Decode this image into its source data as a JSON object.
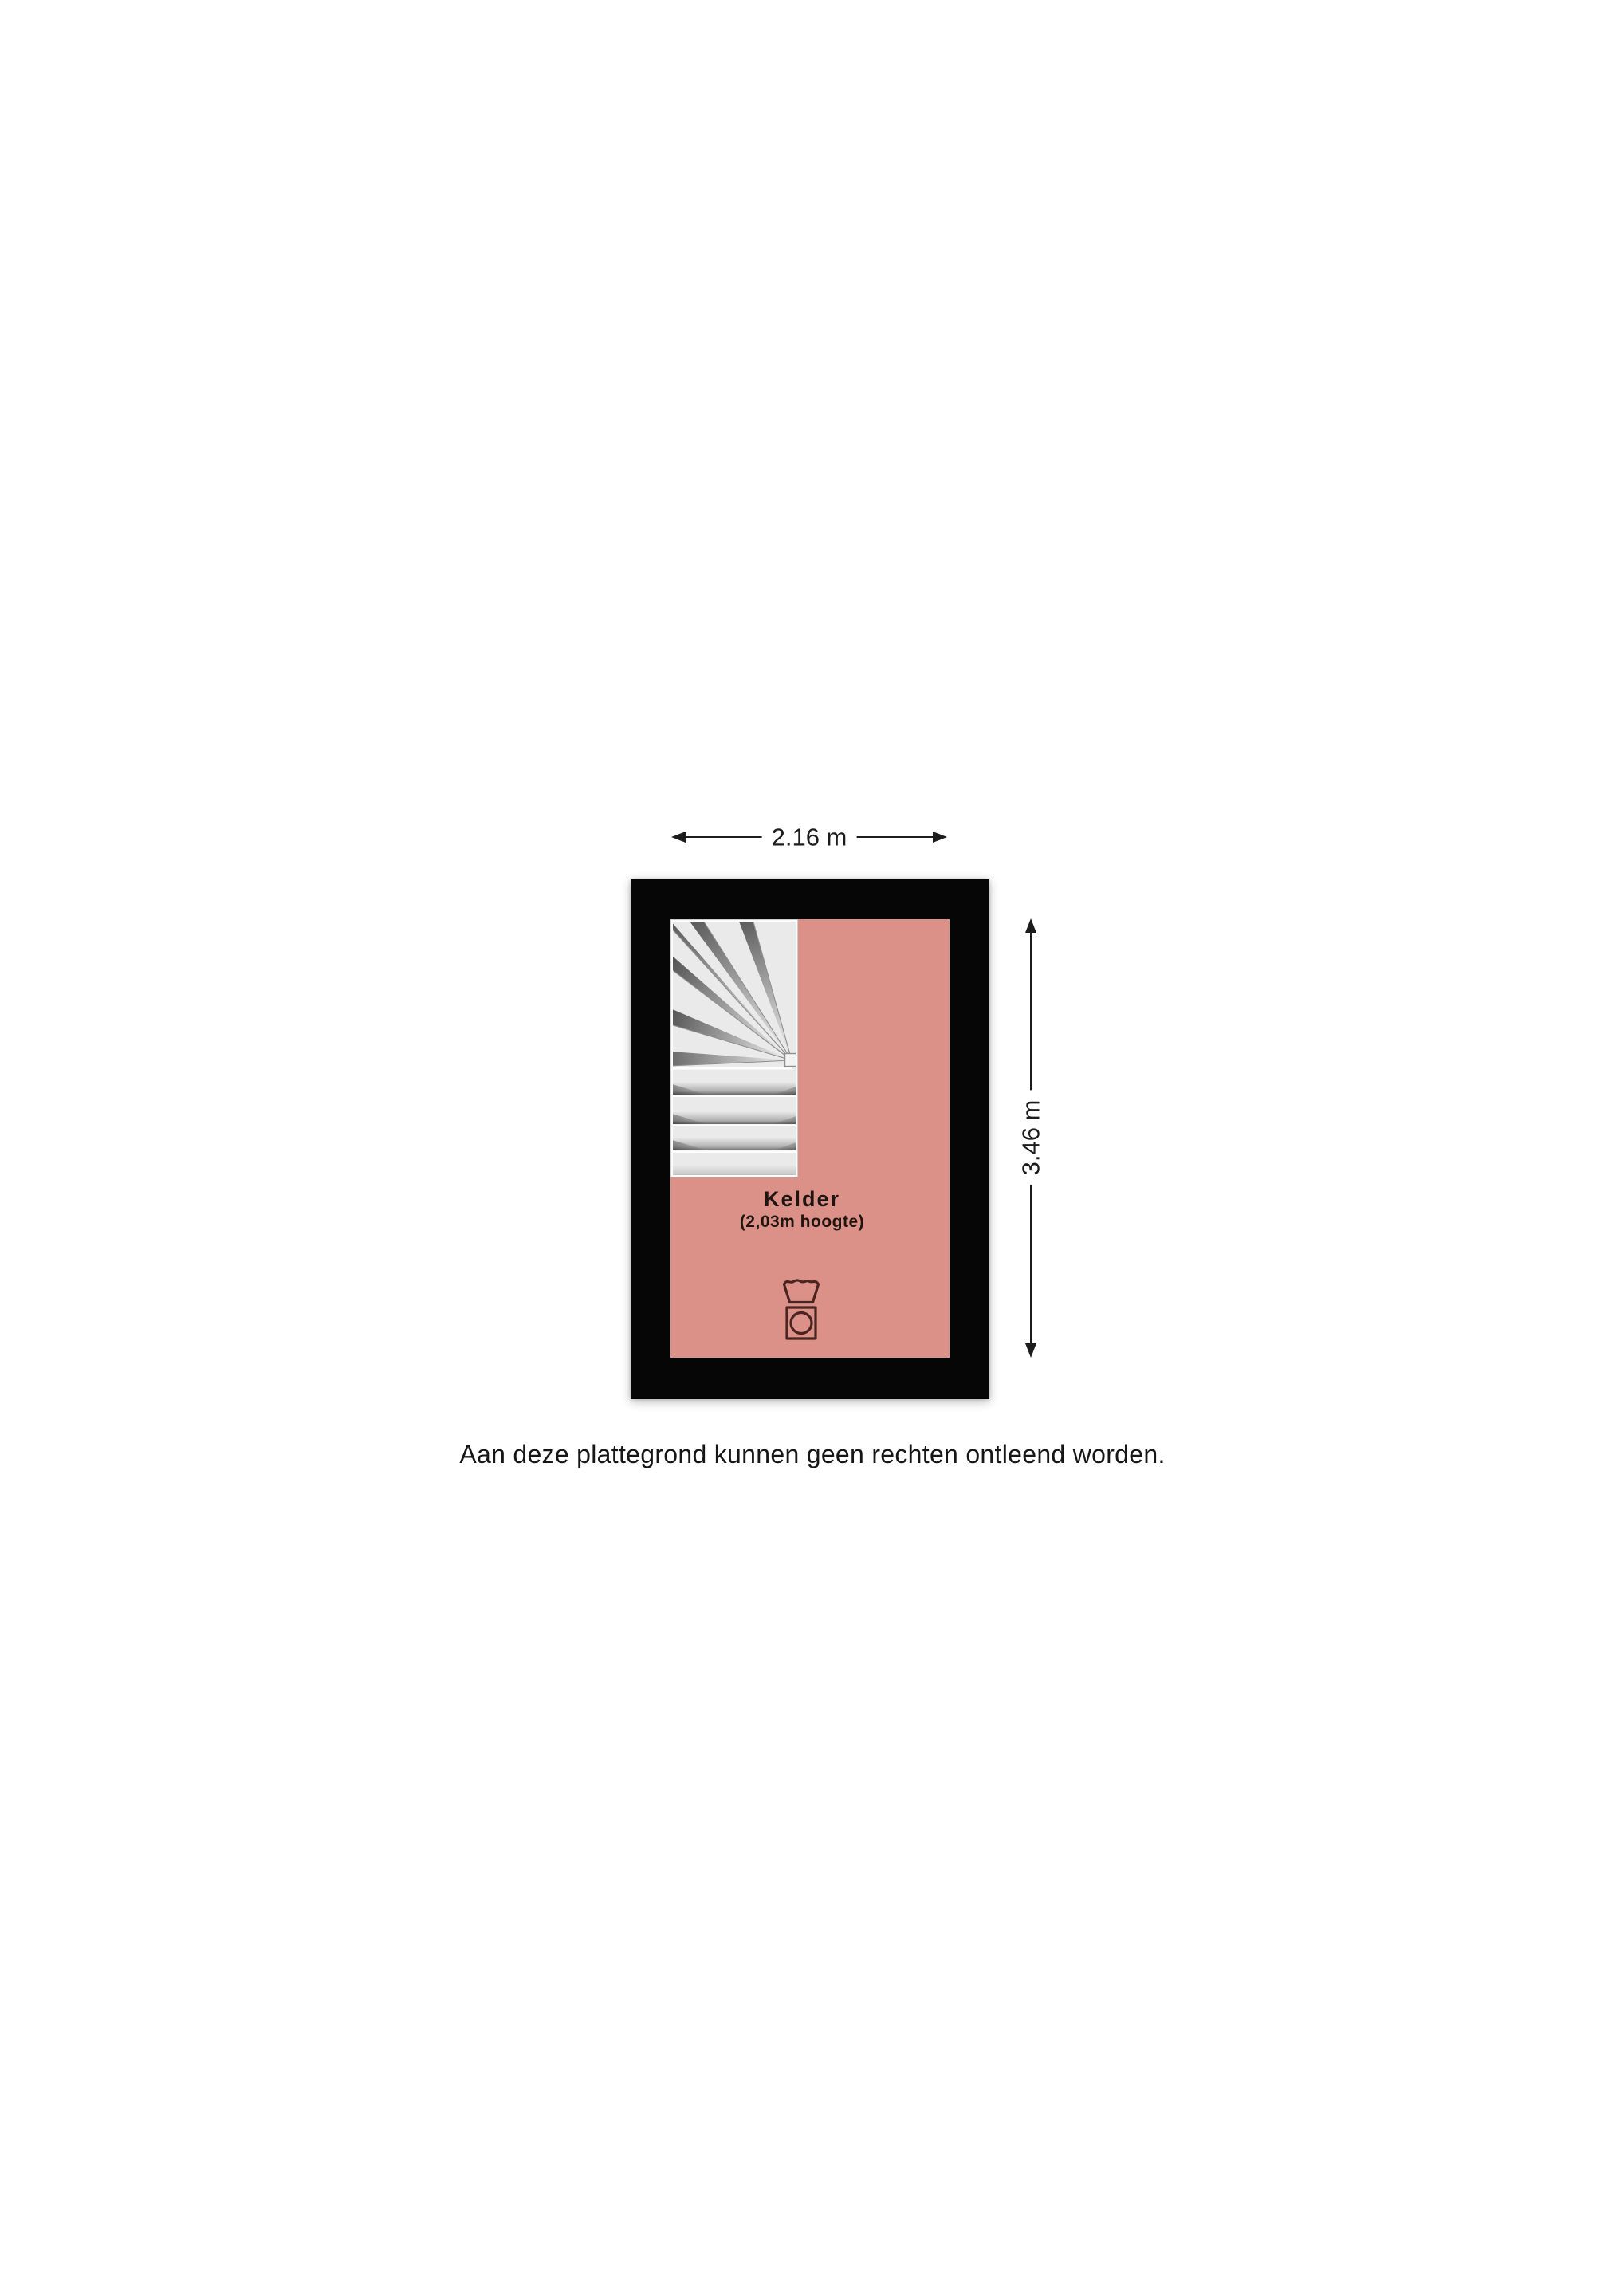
{
  "floorplan": {
    "room": {
      "name": "Kelder",
      "height_note": "(2,03m hoogte)"
    },
    "dimensions": {
      "width_label": "2.16 m",
      "height_label": "3.46 m"
    },
    "caption": "Aan deze plattegrond kunnen geen rechten ontleend worden.",
    "colors": {
      "floor": "#db9187",
      "wall": "#060606",
      "stair_fill": "#eaeaea",
      "dimension_text": "#1c1c1c",
      "room_text": "#1f1410",
      "icon_stroke": "#4a2420",
      "page_background": "#ffffff"
    },
    "icons": [
      {
        "name": "washing-machine-icon"
      },
      {
        "name": "staircase"
      }
    ]
  }
}
